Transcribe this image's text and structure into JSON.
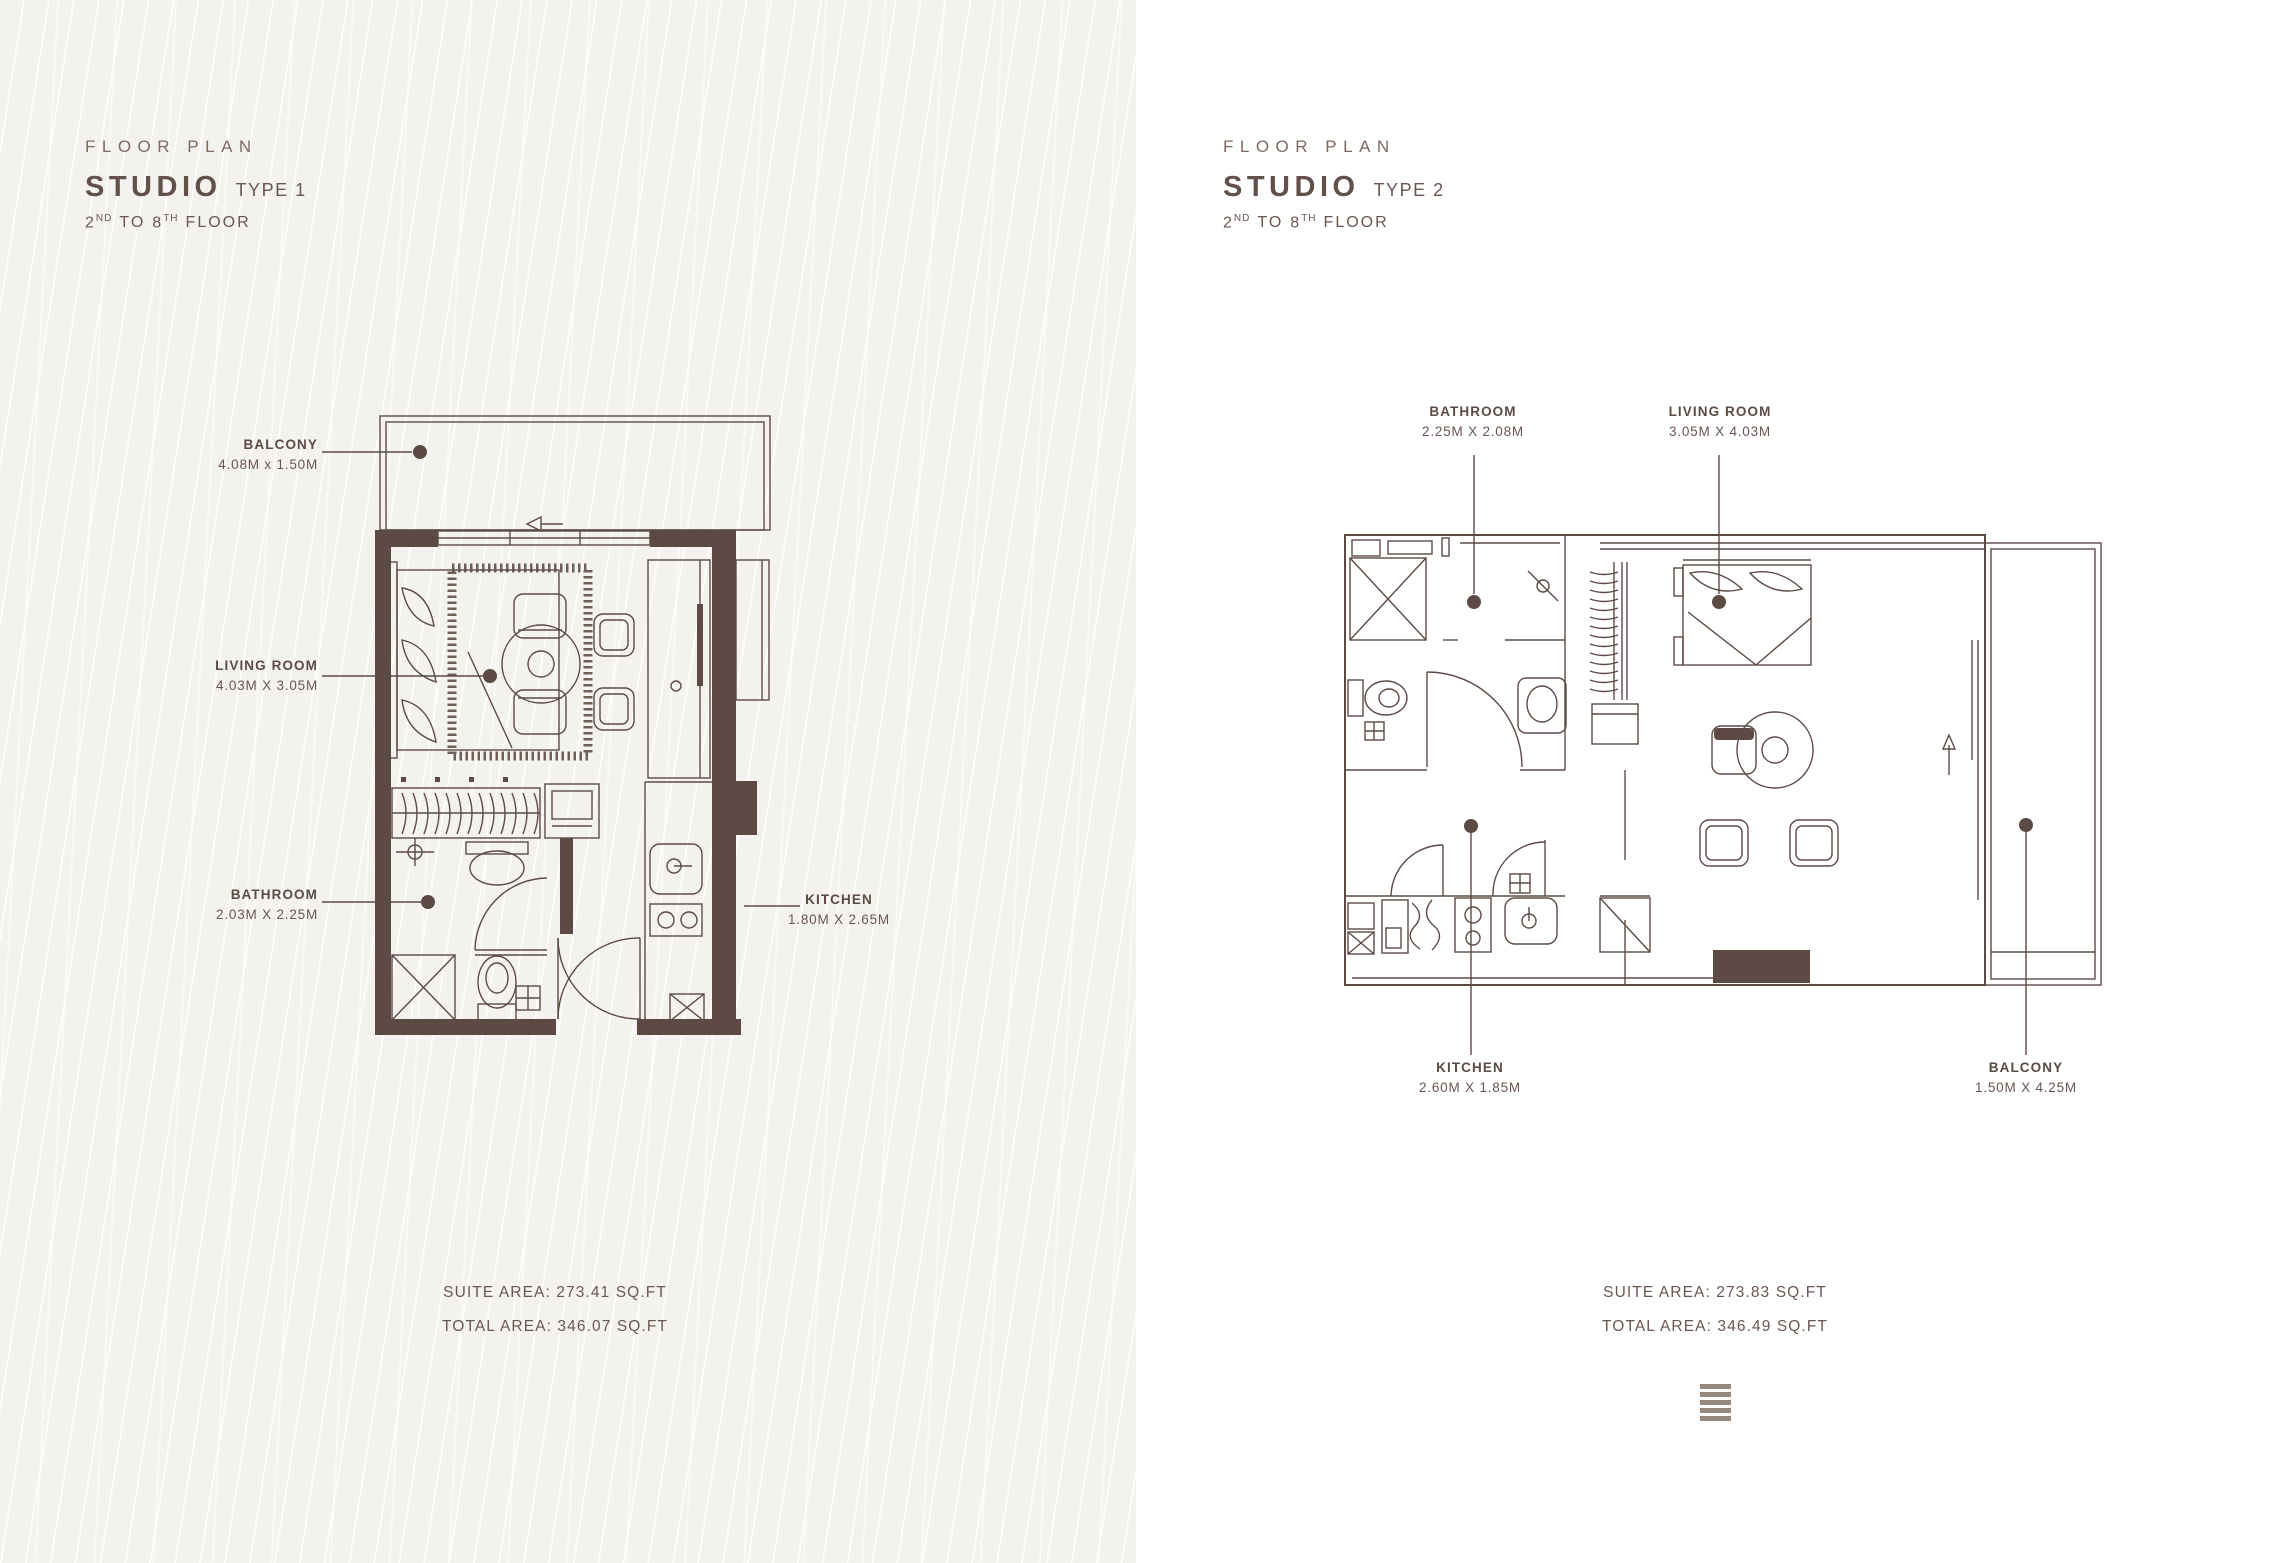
{
  "colors": {
    "ink": "#5d4a44",
    "text": "#6b5650",
    "eyebrow": "#7e6a62",
    "left_background": "#f4f2ee",
    "right_background": "#ffffff",
    "logo": "#95897f"
  },
  "plans": [
    {
      "eyebrow": "FLOOR PLAN",
      "title": "STUDIO",
      "type_label": "TYPE 1",
      "floor": {
        "n1": "2",
        "s1": "ND",
        "mid": "TO",
        "n2": "8",
        "s2": "TH",
        "tail": "FLOOR"
      },
      "rooms": [
        {
          "name": "BALCONY",
          "dims": "4.08M x 1.50M"
        },
        {
          "name": "LIVING ROOM",
          "dims": "4.03M X 3.05M"
        },
        {
          "name": "BATHROOM",
          "dims": "2.03M X 2.25M"
        },
        {
          "name": "KITCHEN",
          "dims": "1.80M X 2.65M"
        }
      ],
      "suite_area": "SUITE AREA: 273.41 SQ.FT",
      "total_area": "TOTAL AREA: 346.07 SQ.FT"
    },
    {
      "eyebrow": "FLOOR PLAN",
      "title": "STUDIO",
      "type_label": "TYPE 2",
      "floor": {
        "n1": "2",
        "s1": "ND",
        "mid": "TO",
        "n2": "8",
        "s2": "TH",
        "tail": "FLOOR"
      },
      "rooms": [
        {
          "name": "BATHROOM",
          "dims": "2.25M X 2.08M"
        },
        {
          "name": "LIVING ROOM",
          "dims": "3.05M X 4.03M"
        },
        {
          "name": "KITCHEN",
          "dims": "2.60M X 1.85M"
        },
        {
          "name": "BALCONY",
          "dims": "1.50M X 4.25M"
        }
      ],
      "suite_area": "SUITE AREA: 273.83 SQ.FT",
      "total_area": "TOTAL AREA: 346.49 SQ.FT"
    }
  ],
  "footer": {
    "logo_icon": "brand-lines-logo"
  }
}
